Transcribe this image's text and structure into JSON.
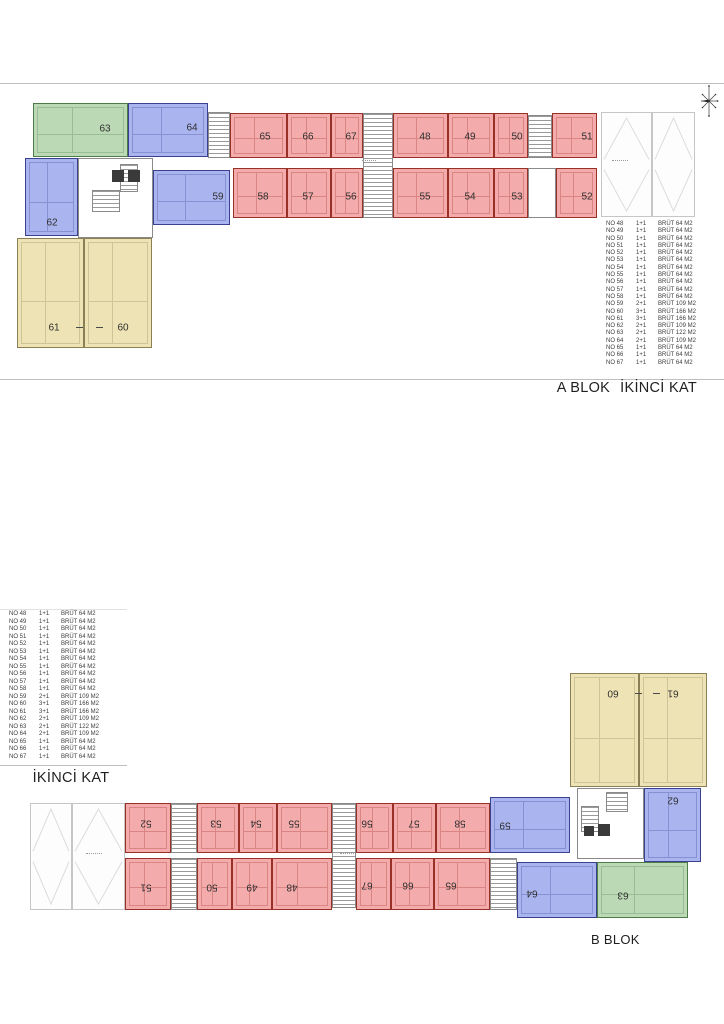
{
  "colors": {
    "red_fill": "#f4abab",
    "red_line": "#993028",
    "blue_fill": "#aab4ee",
    "blue_line": "#3a4290",
    "green_fill": "#bcd9b6",
    "green_line": "#4d7c48",
    "yellow_fill": "#eee3b4",
    "yellow_line": "#8b7f55",
    "garage_line": "#c6c6c6",
    "garage_x": "#dcdcdc",
    "rule": "#bfbfbf",
    "core_line": "#8a8a8a",
    "stair_line": "#9a9a9a",
    "solid": "#3a3a3a",
    "unit_number": "#2f2f2f",
    "table_text": "#3d3d3d",
    "caption_text": "#1f1f1f"
  },
  "titles": {
    "plan_a_block": "A BLOK",
    "plan_a_floor": "İKİNCİ KAT",
    "plan_b_block": "B BLOK",
    "plan_b_floor": "İKİNCİ KAT"
  },
  "legend_rows": [
    {
      "no": "NO 48",
      "type": "1+1",
      "brut": "BRÜT 64 M2"
    },
    {
      "no": "NO 49",
      "type": "1+1",
      "brut": "BRÜT 64 M2"
    },
    {
      "no": "NO 50",
      "type": "1+1",
      "brut": "BRÜT 64 M2"
    },
    {
      "no": "NO 51",
      "type": "1+1",
      "brut": "BRÜT 64 M2"
    },
    {
      "no": "NO 52",
      "type": "1+1",
      "brut": "BRÜT 64 M2"
    },
    {
      "no": "NO 53",
      "type": "1+1",
      "brut": "BRÜT 64 M2"
    },
    {
      "no": "NO 54",
      "type": "1+1",
      "brut": "BRÜT 64 M2"
    },
    {
      "no": "NO 55",
      "type": "1+1",
      "brut": "BRÜT 64 M2"
    },
    {
      "no": "NO 56",
      "type": "1+1",
      "brut": "BRÜT 64 M2"
    },
    {
      "no": "NO 57",
      "type": "1+1",
      "brut": "BRÜT 64 M2"
    },
    {
      "no": "NO 58",
      "type": "1+1",
      "brut": "BRÜT 64 M2"
    },
    {
      "no": "NO 59",
      "type": "2+1",
      "brut": "BRÜT 109 M2"
    },
    {
      "no": "NO 60",
      "type": "3+1",
      "brut": "BRÜT 166 M2"
    },
    {
      "no": "NO 61",
      "type": "3+1",
      "brut": "BRÜT 166 M2"
    },
    {
      "no": "NO 62",
      "type": "2+1",
      "brut": "BRÜT 109 M2"
    },
    {
      "no": "NO 63",
      "type": "2+1",
      "brut": "BRÜT 122 M2"
    },
    {
      "no": "NO 64",
      "type": "2+1",
      "brut": "BRÜT 109 M2"
    },
    {
      "no": "NO 65",
      "type": "1+1",
      "brut": "BRÜT 64 M2"
    },
    {
      "no": "NO 66",
      "type": "1+1",
      "brut": "BRÜT 64 M2"
    },
    {
      "no": "NO 67",
      "type": "1+1",
      "brut": "BRÜT 64 M2"
    }
  ],
  "plan_a": {
    "rotated": false,
    "units": [
      {
        "label": "63",
        "color": "green",
        "rect": [
          33,
          103,
          95,
          54
        ],
        "lp": [
          104,
          128
        ]
      },
      {
        "label": "64",
        "color": "blue",
        "rect": [
          128,
          103,
          80,
          54
        ],
        "lp": [
          191,
          127
        ]
      },
      {
        "label": "62",
        "color": "blue",
        "rect": [
          25,
          158,
          53,
          78
        ],
        "lp": [
          51,
          222
        ]
      },
      {
        "label": "59",
        "color": "blue",
        "rect": [
          153,
          170,
          77,
          55
        ],
        "lp": [
          217,
          196
        ]
      },
      {
        "label": "61",
        "color": "yellow",
        "rect": [
          17,
          238,
          67,
          110
        ],
        "lp": [
          53,
          327
        ]
      },
      {
        "label": "60",
        "color": "yellow",
        "rect": [
          84,
          238,
          68,
          110
        ],
        "lp": [
          122,
          327
        ]
      },
      {
        "label": "65",
        "color": "red",
        "rect": [
          230,
          113,
          57,
          45
        ],
        "lp": [
          264,
          136
        ]
      },
      {
        "label": "66",
        "color": "red",
        "rect": [
          287,
          113,
          44,
          45
        ],
        "lp": [
          307,
          136
        ]
      },
      {
        "label": "67",
        "color": "red",
        "rect": [
          331,
          113,
          32,
          45
        ],
        "lp": [
          350,
          136
        ]
      },
      {
        "label": "48",
        "color": "red",
        "rect": [
          393,
          113,
          55,
          45
        ],
        "lp": [
          424,
          136
        ]
      },
      {
        "label": "49",
        "color": "red",
        "rect": [
          448,
          113,
          46,
          45
        ],
        "lp": [
          469,
          136
        ]
      },
      {
        "label": "50",
        "color": "red",
        "rect": [
          494,
          113,
          34,
          45
        ],
        "lp": [
          516,
          136
        ]
      },
      {
        "label": "51",
        "color": "red",
        "rect": [
          552,
          113,
          45,
          45
        ],
        "lp": [
          586,
          136
        ]
      },
      {
        "label": "58",
        "color": "red",
        "rect": [
          233,
          168,
          54,
          50
        ],
        "lp": [
          262,
          196
        ]
      },
      {
        "label": "57",
        "color": "red",
        "rect": [
          287,
          168,
          44,
          50
        ],
        "lp": [
          307,
          196
        ]
      },
      {
        "label": "56",
        "color": "red",
        "rect": [
          331,
          168,
          32,
          50
        ],
        "lp": [
          350,
          196
        ]
      },
      {
        "label": "55",
        "color": "red",
        "rect": [
          393,
          168,
          55,
          50
        ],
        "lp": [
          424,
          196
        ]
      },
      {
        "label": "54",
        "color": "red",
        "rect": [
          448,
          168,
          46,
          50
        ],
        "lp": [
          469,
          196
        ]
      },
      {
        "label": "53",
        "color": "red",
        "rect": [
          494,
          168,
          34,
          50
        ],
        "lp": [
          516,
          196
        ]
      },
      {
        "label": "52",
        "color": "red",
        "rect": [
          556,
          168,
          41,
          50
        ],
        "lp": [
          586,
          196
        ]
      }
    ],
    "cores": [
      [
        78,
        158,
        75,
        80
      ],
      [
        528,
        168,
        28,
        50
      ]
    ],
    "stairs": [
      [
        208,
        112,
        22,
        46
      ],
      [
        363,
        113,
        30,
        105
      ],
      [
        528,
        115,
        24,
        43
      ],
      [
        92,
        190,
        28,
        22
      ],
      [
        120,
        164,
        18,
        28
      ]
    ],
    "solids": [
      [
        112,
        170,
        12,
        12
      ],
      [
        128,
        170,
        12,
        12
      ]
    ],
    "garage": {
      "rect": [
        601,
        112,
        94,
        105
      ],
      "bays": [
        [
          601,
          112,
          51,
          105
        ],
        [
          652,
          112,
          43,
          105
        ]
      ]
    },
    "dashes": [
      [
        76,
        327,
        7,
        1
      ],
      [
        96,
        327,
        7,
        1
      ]
    ],
    "tiny": [
      [
        362,
        160,
        14,
        3
      ],
      [
        612,
        160,
        16,
        3
      ]
    ]
  },
  "plan_b": {
    "rotated": true,
    "units": [
      {
        "label": "60",
        "color": "yellow",
        "rect": [
          570,
          673,
          69,
          114
        ],
        "lp": [
          612,
          692
        ]
      },
      {
        "label": "61",
        "color": "yellow",
        "rect": [
          639,
          673,
          68,
          114
        ],
        "lp": [
          672,
          692
        ]
      },
      {
        "label": "62",
        "color": "blue",
        "rect": [
          644,
          788,
          57,
          74
        ],
        "lp": [
          672,
          799
        ]
      },
      {
        "label": "59",
        "color": "blue",
        "rect": [
          490,
          797,
          80,
          56
        ],
        "lp": [
          504,
          824
        ]
      },
      {
        "label": "64",
        "color": "blue",
        "rect": [
          517,
          862,
          80,
          56
        ],
        "lp": [
          531,
          892
        ]
      },
      {
        "label": "63",
        "color": "green",
        "rect": [
          597,
          862,
          91,
          56
        ],
        "lp": [
          622,
          894
        ]
      },
      {
        "label": "52",
        "color": "red",
        "rect": [
          125,
          803,
          46,
          50
        ],
        "lp": [
          145,
          822
        ]
      },
      {
        "label": "53",
        "color": "red",
        "rect": [
          197,
          803,
          42,
          50
        ],
        "lp": [
          215,
          822
        ]
      },
      {
        "label": "54",
        "color": "red",
        "rect": [
          239,
          803,
          38,
          50
        ],
        "lp": [
          255,
          822
        ]
      },
      {
        "label": "55",
        "color": "red",
        "rect": [
          277,
          803,
          55,
          50
        ],
        "lp": [
          293,
          822
        ]
      },
      {
        "label": "56",
        "color": "red",
        "rect": [
          356,
          803,
          37,
          50
        ],
        "lp": [
          366,
          822
        ]
      },
      {
        "label": "57",
        "color": "red",
        "rect": [
          393,
          803,
          43,
          50
        ],
        "lp": [
          413,
          822
        ]
      },
      {
        "label": "58",
        "color": "red",
        "rect": [
          436,
          803,
          54,
          50
        ],
        "lp": [
          459,
          822
        ]
      },
      {
        "label": "51",
        "color": "red",
        "rect": [
          125,
          858,
          46,
          52
        ],
        "lp": [
          145,
          886
        ]
      },
      {
        "label": "50",
        "color": "red",
        "rect": [
          197,
          858,
          35,
          52
        ],
        "lp": [
          211,
          886
        ]
      },
      {
        "label": "49",
        "color": "red",
        "rect": [
          232,
          858,
          40,
          52
        ],
        "lp": [
          251,
          886
        ]
      },
      {
        "label": "48",
        "color": "red",
        "rect": [
          272,
          858,
          60,
          52
        ],
        "lp": [
          291,
          886
        ]
      },
      {
        "label": "67",
        "color": "red",
        "rect": [
          356,
          858,
          35,
          52
        ],
        "lp": [
          366,
          884
        ]
      },
      {
        "label": "66",
        "color": "red",
        "rect": [
          391,
          858,
          43,
          52
        ],
        "lp": [
          407,
          884
        ]
      },
      {
        "label": "65",
        "color": "red",
        "rect": [
          434,
          858,
          56,
          52
        ],
        "lp": [
          450,
          884
        ]
      }
    ],
    "cores": [
      [
        577,
        788,
        67,
        71
      ]
    ],
    "stairs": [
      [
        171,
        803,
        26,
        50
      ],
      [
        332,
        803,
        24,
        105
      ],
      [
        171,
        858,
        26,
        52
      ],
      [
        490,
        858,
        27,
        52
      ],
      [
        606,
        792,
        22,
        20
      ],
      [
        581,
        806,
        18,
        26
      ]
    ],
    "solids": [
      [
        598,
        824,
        12,
        12
      ],
      [
        584,
        826,
        10,
        10
      ]
    ],
    "garage": {
      "rect": [
        30,
        803,
        95,
        107
      ],
      "bays": [
        [
          30,
          803,
          42,
          107
        ],
        [
          72,
          803,
          53,
          107
        ]
      ]
    },
    "dashes": [
      [
        635,
        693,
        7,
        1
      ],
      [
        653,
        693,
        7,
        1
      ]
    ],
    "tiny": [
      [
        86,
        853,
        16,
        3
      ],
      [
        340,
        853,
        14,
        3
      ]
    ]
  }
}
